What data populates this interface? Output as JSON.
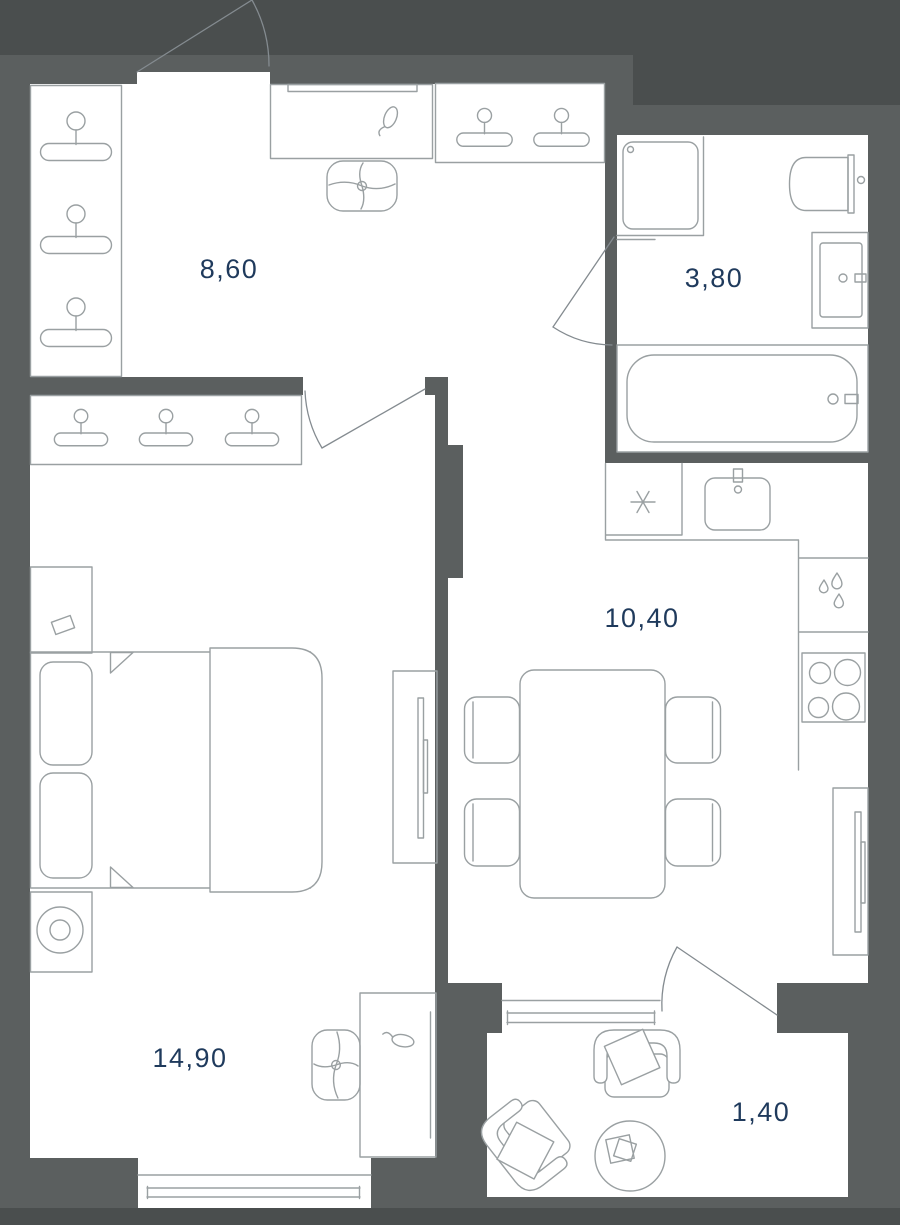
{
  "plan": {
    "type": "apartment-floor-plan",
    "rooms": [
      {
        "name": "hallway",
        "area_label": "8,60",
        "furniture": [
          "wardrobe with 3 hangers",
          "closet with 2 hangers",
          "desk",
          "desk lamp",
          "office chair",
          "entrance door"
        ]
      },
      {
        "name": "bathroom",
        "area_label": "3,80",
        "furniture": [
          "washing machine",
          "toilet",
          "washbasin",
          "bathtub",
          "door"
        ]
      },
      {
        "name": "kitchen",
        "area_label": "10,40",
        "furniture": [
          "refrigerator",
          "sink",
          "dishwasher",
          "stove 4 burners",
          "dining table",
          "4 chairs",
          "wall tv",
          "window",
          "balcony door"
        ]
      },
      {
        "name": "bedroom",
        "area_label": "14,90",
        "furniture": [
          "closet with 3 hangers",
          "double bed",
          "2 pillows",
          "nightstand with lamp",
          "nightstand with book",
          "wall tv",
          "desk",
          "desk lamp",
          "office chair",
          "window"
        ]
      },
      {
        "name": "balcony",
        "area_label": "1,40",
        "furniture": [
          "2 armchairs",
          "round table"
        ]
      }
    ],
    "colors": {
      "wall": "#5b5f5f",
      "wall_dark": "#4a4e4e",
      "floor": "#ffffff",
      "furniture_line": "#9aa0a2",
      "door_line": "#848b90",
      "label_text": "#1f3a5c"
    }
  }
}
